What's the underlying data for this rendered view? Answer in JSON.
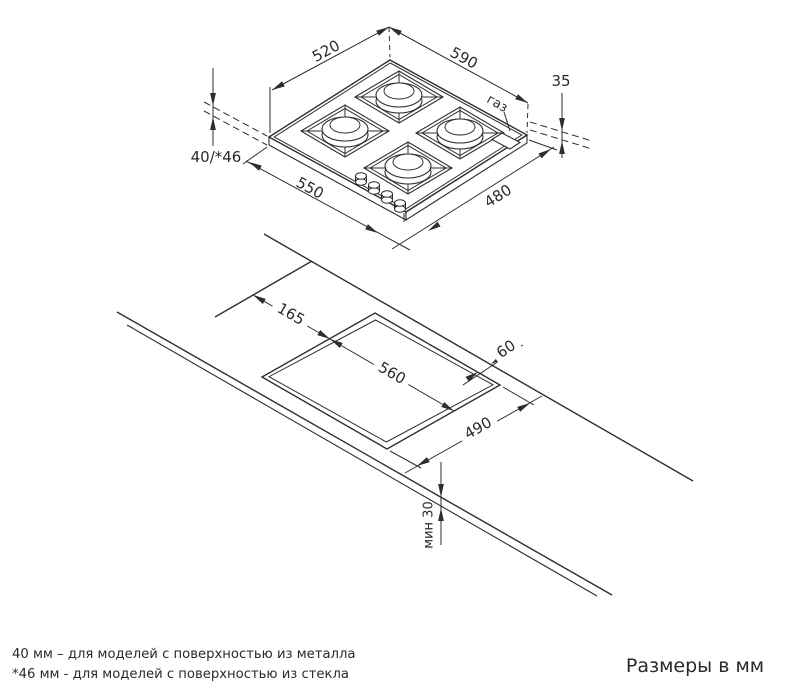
{
  "colors": {
    "ink": "#2e2e2e",
    "background": "#ffffff"
  },
  "top_view": {
    "d520": "520",
    "d590": "590",
    "d35": "35",
    "gas": "газ",
    "d4046": "40/*46",
    "d550": "550",
    "d480": "480"
  },
  "cutout_view": {
    "d165": "165",
    "d560": "560",
    "d60": "60",
    "d490": "490",
    "dmin30": "мин 30"
  },
  "footnotes": {
    "line1": "40 мм – для моделей с поверхностью  из металла",
    "line2": "*46 мм - для моделей с поверхностью  из стекла"
  },
  "units_note": "Размеры в мм"
}
